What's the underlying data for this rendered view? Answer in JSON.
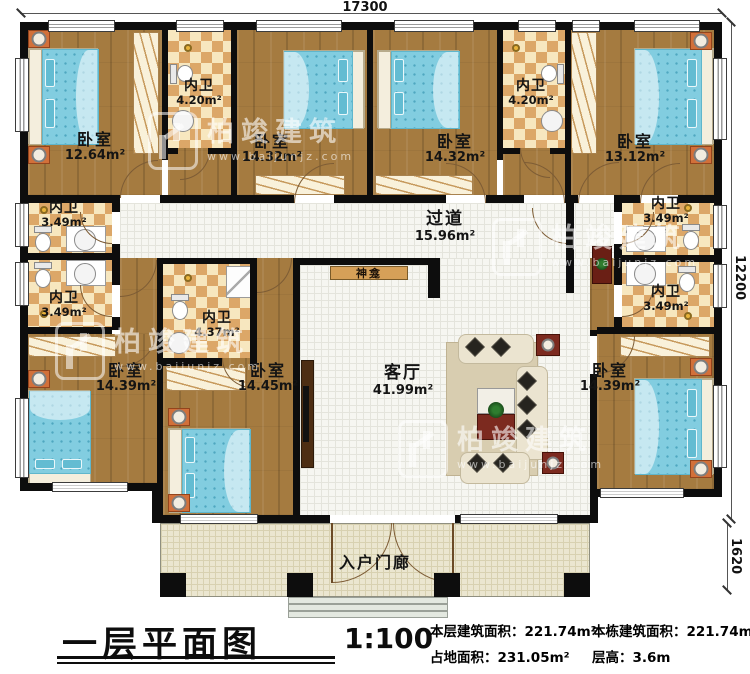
{
  "dimensions": {
    "top_width": "17300",
    "right_height": "12200",
    "porch_height": "1620"
  },
  "rooms": [
    {
      "id": "bedroom-top-left",
      "name": "卧室",
      "area": "12.64m²"
    },
    {
      "id": "bathroom-top-1",
      "name": "内卫",
      "area": "4.20m²"
    },
    {
      "id": "bedroom-top-center-1",
      "name": "卧室",
      "area": "14.32m²"
    },
    {
      "id": "bedroom-top-center-2",
      "name": "卧室",
      "area": "14.32m²"
    },
    {
      "id": "bathroom-top-2",
      "name": "内卫",
      "area": "4.20m²"
    },
    {
      "id": "bedroom-top-right",
      "name": "卧室",
      "area": "13.12m²"
    },
    {
      "id": "bathroom-left-1",
      "name": "内卫",
      "area": "3.49m²"
    },
    {
      "id": "bathroom-left-2",
      "name": "内卫",
      "area": "3.49m²"
    },
    {
      "id": "corridor",
      "name": "过道",
      "area": "15.96m²"
    },
    {
      "id": "bathroom-right-1",
      "name": "内卫",
      "area": "3.49m²"
    },
    {
      "id": "bathroom-right-2",
      "name": "内卫",
      "area": "3.49m²"
    },
    {
      "id": "bathroom-center",
      "name": "内卫",
      "area": "4.37m²"
    },
    {
      "id": "bedroom-bottom-left",
      "name": "卧室",
      "area": "14.39m²"
    },
    {
      "id": "bedroom-bottom-center",
      "name": "卧室",
      "area": "14.45m²"
    },
    {
      "id": "living-room",
      "name": "客厅",
      "area": "41.99m²"
    },
    {
      "id": "bedroom-bottom-right",
      "name": "卧室",
      "area": "14.39m²"
    },
    {
      "id": "entrance-porch",
      "name": "入户门廊"
    },
    {
      "id": "shrine",
      "name": "神龛"
    }
  ],
  "title_block": {
    "plan_name": "一层平面图",
    "scale": "1:100",
    "stats": [
      {
        "label": "本层建筑面积：",
        "value": "221.74m²"
      },
      {
        "label": "本栋建筑面积：",
        "value": "221.74m²"
      },
      {
        "label": "占地面积：",
        "value": "231.05m²"
      },
      {
        "label": "层高：",
        "value": "3.6m"
      }
    ]
  },
  "watermark": {
    "brand": "柏竣建筑",
    "url": "www.baijunjz.com"
  },
  "colors": {
    "wall": "#0d0d0d",
    "wood": "#a57b40",
    "tile_dark": "#dca768",
    "mattress": "#82cde0",
    "accent_red": "#7c2a1f"
  }
}
